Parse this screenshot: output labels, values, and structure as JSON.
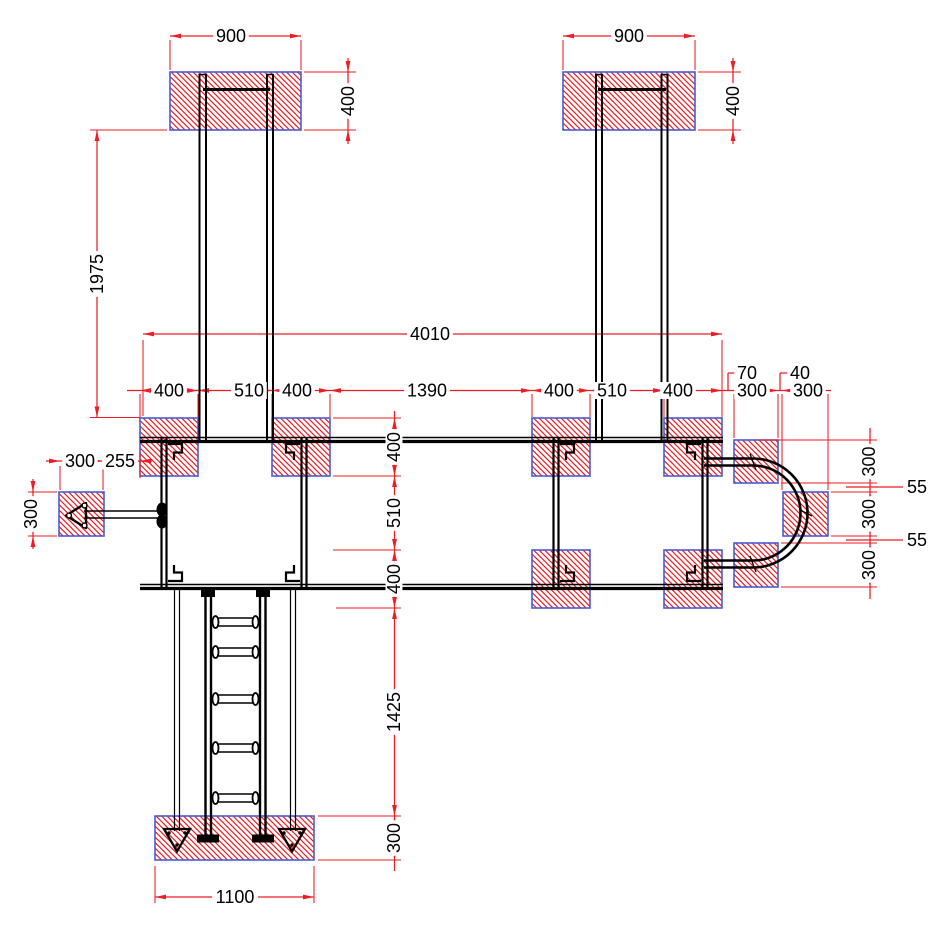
{
  "drawing": {
    "type": "foundation-anchoring-plan",
    "units": "mm",
    "colors": {
      "dimension": "#ee1d23",
      "hatch": "#ee1d23",
      "footing_border": "#4a5bd0",
      "structure": "#000000",
      "background": "#ffffff",
      "text": "#000000"
    },
    "dimensions": [
      {
        "value": "900",
        "x": 231,
        "y": 36,
        "rot": 0
      },
      {
        "value": "900",
        "x": 629,
        "y": 36,
        "rot": 0
      },
      {
        "value": "400",
        "x": 348,
        "y": 101,
        "rot": -90
      },
      {
        "value": "400",
        "x": 733,
        "y": 101,
        "rot": -90
      },
      {
        "value": "1975",
        "x": 97,
        "y": 274,
        "rot": -90
      },
      {
        "value": "4010",
        "x": 430,
        "y": 334,
        "rot": 0
      },
      {
        "value": "400",
        "x": 169,
        "y": 390.5,
        "rot": 0
      },
      {
        "value": "510",
        "x": 249,
        "y": 390.5,
        "rot": 0
      },
      {
        "value": "400",
        "x": 297,
        "y": 390.5,
        "rot": 0
      },
      {
        "value": "1390",
        "x": 427,
        "y": 390.5,
        "rot": 0
      },
      {
        "value": "400",
        "x": 559,
        "y": 390.5,
        "rot": 0
      },
      {
        "value": "510",
        "x": 612,
        "y": 390.5,
        "rot": 0
      },
      {
        "value": "400",
        "x": 678,
        "y": 390.5,
        "rot": 0
      },
      {
        "value": "300",
        "x": 752,
        "y": 390.5,
        "rot": 0
      },
      {
        "value": "300",
        "x": 808,
        "y": 390.5,
        "rot": 0
      },
      {
        "value": "70",
        "x": 747,
        "y": 373,
        "rot": 0
      },
      {
        "value": "40",
        "x": 800,
        "y": 373,
        "rot": 0
      },
      {
        "value": "300",
        "x": 80,
        "y": 461,
        "rot": 0
      },
      {
        "value": "255",
        "x": 120,
        "y": 461,
        "rot": 0
      },
      {
        "value": "300",
        "x": 31,
        "y": 514,
        "rot": -90
      },
      {
        "value": "300",
        "x": 869,
        "y": 461.5,
        "rot": -90
      },
      {
        "value": "55",
        "x": 917,
        "y": 487,
        "rot": 0
      },
      {
        "value": "300",
        "x": 869,
        "y": 514,
        "rot": -90
      },
      {
        "value": "55",
        "x": 917,
        "y": 540,
        "rot": 0
      },
      {
        "value": "300",
        "x": 869,
        "y": 565,
        "rot": -90
      },
      {
        "value": "400",
        "x": 394,
        "y": 447,
        "rot": -90
      },
      {
        "value": "510",
        "x": 394,
        "y": 513,
        "rot": -90
      },
      {
        "value": "400",
        "x": 394,
        "y": 579,
        "rot": -90
      },
      {
        "value": "1425",
        "x": 394,
        "y": 712,
        "rot": -90
      },
      {
        "value": "300",
        "x": 394,
        "y": 838,
        "rot": -90
      },
      {
        "value": "1100",
        "x": 235,
        "y": 897,
        "rot": 0
      }
    ]
  }
}
